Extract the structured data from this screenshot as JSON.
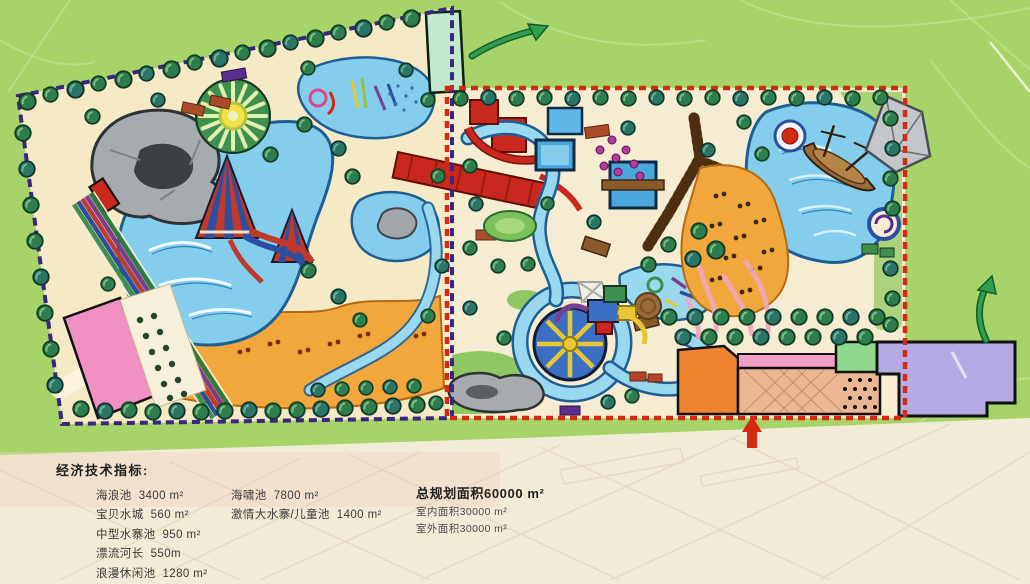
{
  "indicators": {
    "heading": "经济技术指标:",
    "left": [
      {
        "label": "海浪池",
        "value": "3400 m²"
      },
      {
        "label": "宝贝水城",
        "value": "560 m²"
      },
      {
        "label": "中型水寨池",
        "value": "950 m²"
      },
      {
        "label": "漂流河长",
        "value": "550m"
      },
      {
        "label": "浪漫休闲池",
        "value": "1280 m²"
      }
    ],
    "middle": [
      {
        "label": "海啸池",
        "value": "7800 m²"
      },
      {
        "label": "激情大水寨/儿童池",
        "value": "1400 m²"
      }
    ],
    "right": {
      "total": {
        "label": "总规划面积",
        "value": "60000 m²"
      },
      "sub": [
        {
          "label": "室内面积",
          "value": "30000 m²"
        },
        {
          "label": "室外面积",
          "value": "30000 m²"
        }
      ]
    }
  },
  "map": {
    "palette": {
      "background_green": "#a7d469",
      "background_cream": "#f2ebd8",
      "parcel_sand": "#f5e9c6",
      "beach_orange": "#f2a73c",
      "water_blue": "#85cdec",
      "water_outline": "#1d5f94",
      "tree_green": "#2e7d4e",
      "left_boundary_purple": "#3a2580",
      "right_boundary_red": "#d42a12",
      "slide_red": "#c8281e",
      "wood_brown": "#8a5a2d",
      "building_pink": "#ef8fc4",
      "building_orange": "#ef8430",
      "building_green": "#8ed98e",
      "building_purple": "#b6aae4",
      "arrow_green": "#2f9e4f"
    },
    "features": [
      "left-park-parcel",
      "right-park-parcel",
      "wave-pool",
      "kids-pool",
      "rock-cave",
      "racing-slides",
      "sun-carousel",
      "cone-slide-towers",
      "lazy-river",
      "tsunami-pool",
      "pirate-ship",
      "sail-canopy",
      "water-wheel-fortress",
      "wooden-boardwalk",
      "sand-beach",
      "entrance-plaza",
      "entrance-arrow",
      "flow-arrow"
    ]
  }
}
